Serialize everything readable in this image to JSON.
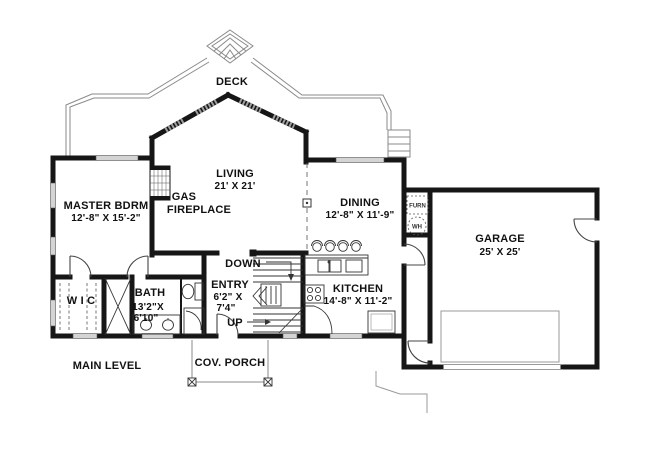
{
  "plan": {
    "labels": {
      "deck": "DECK",
      "living": {
        "name": "LIVING",
        "dims": "21' X 21'"
      },
      "fireplace": {
        "line1": "GAS",
        "line2": "FIREPLACE"
      },
      "master": {
        "name": "MASTER BDRM",
        "dims": "12'-8\" X 15'-2\""
      },
      "dining": {
        "name": "DINING",
        "dims": "12'-8\" X 11'-9\""
      },
      "garage": {
        "name": "GARAGE",
        "dims": "25' X 25'"
      },
      "kitchen": {
        "name": "KITCHEN",
        "dims": "14'-8\" X 11'-2\""
      },
      "entry": {
        "name": "ENTRY",
        "dims1": "6'2\" X",
        "dims2": "7'4\""
      },
      "bath": {
        "name": "BATH",
        "dims1": "13'2\"X",
        "dims2": "6'10\""
      },
      "wic": "W I C",
      "furnace": "FURN",
      "water_heater": "WH",
      "down": "DOWN",
      "up": "UP",
      "porch": "COV. PORCH",
      "main_level": "MAIN LEVEL"
    },
    "colors": {
      "wall": "#161616",
      "thin_line": "#8a8a8a",
      "window": "#d4d4d4",
      "text": "#111111",
      "background": "#ffffff"
    }
  }
}
